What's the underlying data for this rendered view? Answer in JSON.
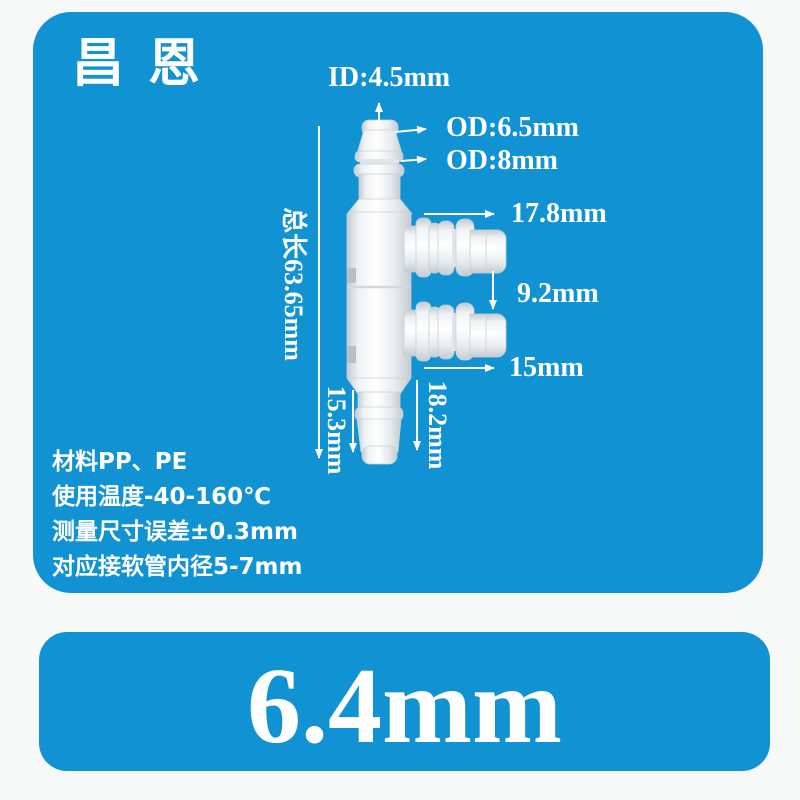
{
  "colors": {
    "panel_blue": "#1193d3",
    "page_bg": "#f7f8f8",
    "label_white": "#ffffff"
  },
  "brand": "昌恩",
  "dimensions": {
    "inner_diameter": "ID:4.5mm",
    "outer_diameter_tip": "OD:6.5mm",
    "outer_diameter_barb": "OD:8mm",
    "side_port_upper_length": "17.8mm",
    "port_gap": "9.2mm",
    "side_port_lower_length": "15mm",
    "total_length": "总长63.65mm",
    "bottom_port_left_length": "15.3mm",
    "bottom_port_right_length": "18.2mm"
  },
  "specs": [
    "材料PP、PE",
    "使用温度-40-160℃",
    "测量尺寸误差±0.3mm",
    "对应接软管内径5-7mm"
  ],
  "size_badge": "6.4mm"
}
